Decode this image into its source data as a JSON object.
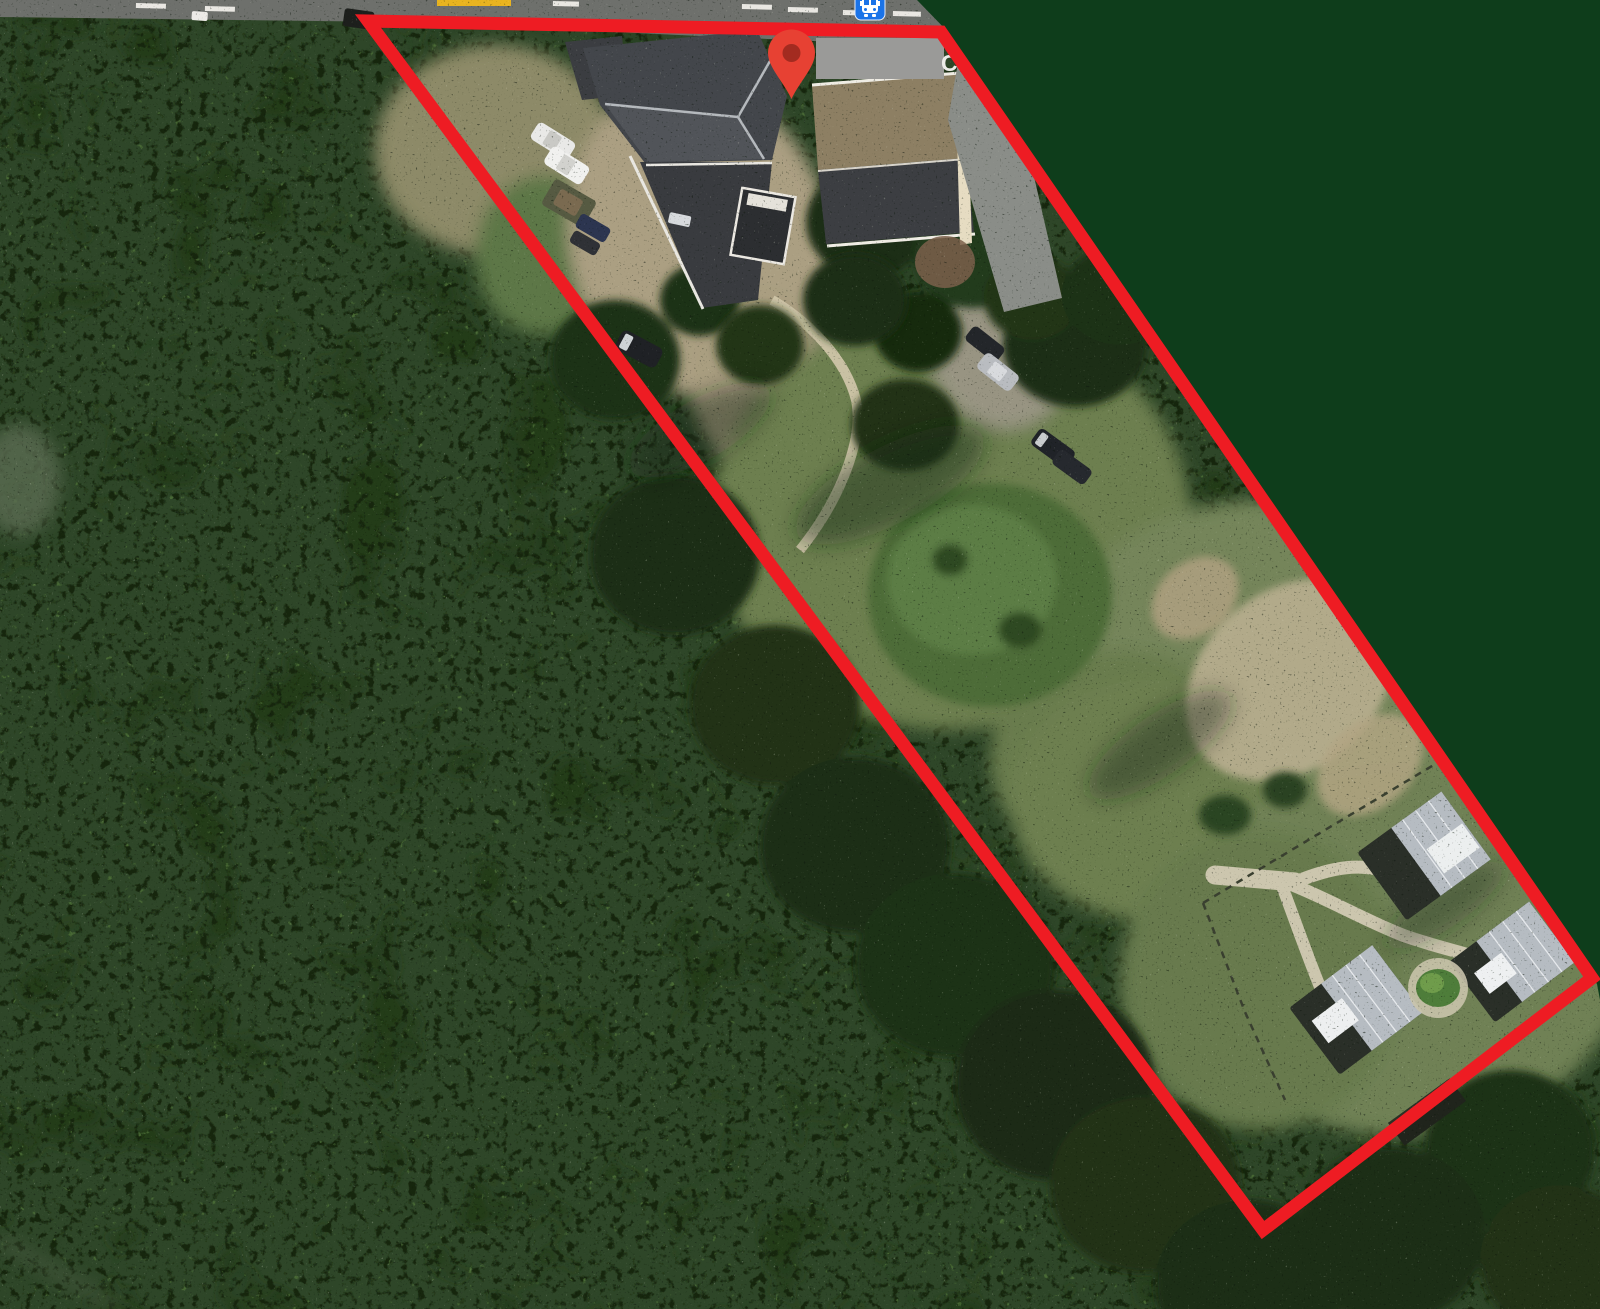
{
  "window": {
    "title": "Satellite map view with property boundary overlay"
  },
  "map": {
    "view_type": "satellite-imagery",
    "partial_label": "C",
    "boundary_points": "368,21 941,32 1592,978 1263,1230",
    "mask_points": "917,0 1600,0 1600,1000 1597,984 949,33",
    "colors": {
      "boundary": "#ee1c23",
      "mask": "#0e3d1b",
      "pin": "#e74133",
      "pin_inner": "#a32b20",
      "bus_icon_bg": "#1a73e8",
      "bus_icon_glyph": "#ffffff",
      "privacy_rect": "#9a9a98",
      "road": "#6e706c",
      "road_dash": "#e9e7e2",
      "road_label_fragment": "#e9b41f",
      "roof_dark": "#43464b",
      "roof_dark_lower": "#393b3f",
      "roof_tan": "#8d7f63",
      "cabin_roof": "#b6bcc2",
      "path": "#ccc6ae"
    },
    "icons": [
      "red-map-pin",
      "bus-stop",
      "road-label-fragment"
    ]
  }
}
